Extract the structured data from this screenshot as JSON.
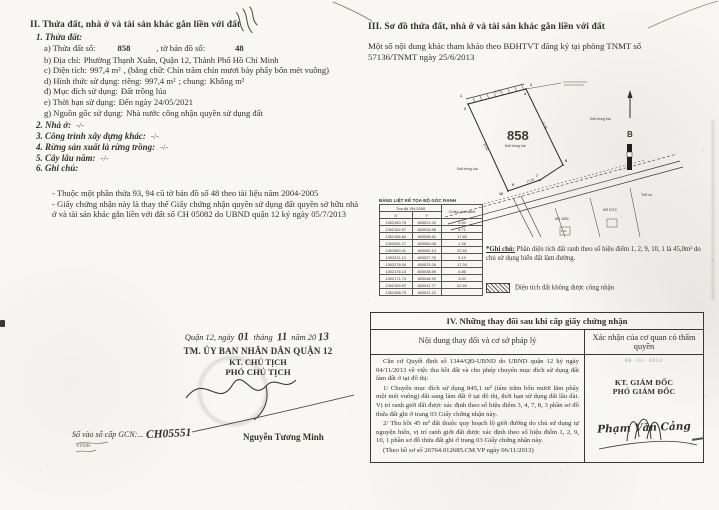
{
  "section2": {
    "title": "II. Thửa đất, nhà ở và tài sản khác gắn liền với đất",
    "plot_heading": "1. Thửa đất:",
    "plot_line": {
      "label1": "a) Thửa đất số:",
      "value1": "858",
      "label2": ", tờ bản đồ số:",
      "value2": "48"
    },
    "fields": [
      {
        "label": "b) Địa chỉ:",
        "value": "Phường Thạnh Xuân, Quận 12, Thành Phố Hồ Chí Minh",
        "label2": "",
        "value2": ""
      },
      {
        "label": "c) Diện tích:",
        "value": "997,4 m²",
        "label2": ", (bằng chữ: Chín trăm chín mươi bảy phẩy bốn mét vuông)",
        "value2": ""
      },
      {
        "label": "d) Hình thức sử dụng: riêng:",
        "value": "997,4 m²",
        "label2": "; chung:",
        "value2": "Không m²"
      },
      {
        "label": "đ) Mục đích sử dụng:",
        "value": "Đất trồng lúa",
        "label2": "",
        "value2": ""
      },
      {
        "label": "e) Thời hạn sử dụng:",
        "value": "Đến ngày 24/05/2021",
        "label2": "",
        "value2": ""
      },
      {
        "label": "g) Nguồn gốc sử dụng:",
        "value": "Nhà nước công nhận quyền sử dụng đất",
        "label2": "",
        "value2": ""
      }
    ],
    "subsections": [
      {
        "label": "2. Nhà ở:",
        "value": "-/-"
      },
      {
        "label": "3. Công trình xây dựng khác:",
        "value": "-/-"
      },
      {
        "label": "4. Rừng sản xuất là rừng trồng:",
        "value": "-/-"
      },
      {
        "label": "5. Cây lâu năm:",
        "value": "-/-"
      },
      {
        "label": "6. Ghi chú:",
        "value": ""
      }
    ],
    "notes": [
      {
        "text": "- Thuộc một phần thửa 93, 94 cũ tờ bản đồ số 48 theo tài liệu năm 2004-2005"
      },
      {
        "text": "- Giấy chứng nhận này là thay thế Giấy chứng nhận quyền sử dụng đất quyền sở hữu nhà ở và tài sản khác gắn liền với đất số CH 05082 do UBND quận 12 ký ngày 05/7/2013"
      }
    ]
  },
  "issuer": {
    "place_label": "Quận 12, ngày",
    "day": "01",
    "month_label": "tháng",
    "month": "11",
    "year_label": "năm 20",
    "year": "13",
    "committee": "TM. ỦY BAN NHÂN DÂN QUẬN 12",
    "kt": "KT. CHỦ TỊCH",
    "role": "PHÓ CHỦ TỊCH",
    "name": "Nguyễn Tương Minh",
    "book_label": "Số vào sổ cấp GCN:...",
    "book_no": "CH05551",
    "clerk_note": "VPĐK"
  },
  "section3": {
    "title": "III. Sơ đồ thửa đất, nhà ở và tài sản khác gắn liền với đất",
    "intro": "Một số nội dung khác tham khảo theo BĐHTVT đăng ký tại phòng TNMT số 57136/TNMT ngày 25/6/2013",
    "diagram": {
      "parcel_no": "858",
      "parcel_use": "Đất trồng lúa",
      "neighbor_use_left": "Đất trồng lúa",
      "neighbor_use_right": "Đất trồng lúa",
      "north_label": "B",
      "label_tho_cu": "Thổ cư",
      "label_ms1": "MS 1853",
      "label_ms2": "MS 6713",
      "label_house": "1 hộ",
      "edge_labels": [
        "6.71",
        "22.50",
        "17.34",
        "17.60"
      ],
      "point_labels": [
        "1",
        "2",
        "3",
        "4",
        "7",
        "8",
        "9",
        "10"
      ]
    },
    "coords_table": {
      "title": "BẢNG LIỆT KÊ TỌA ĐỘ GÓC RANH",
      "group_header": "Tọa độ VN-2000",
      "col_x": "X",
      "col_y": "Y",
      "col_len": "Chiều dài cạnh",
      "rows": [
        {
          "x": "1302160.75",
          "y": "600021.33",
          "len": "2.00"
        },
        {
          "x": "1302162.57",
          "y": "600028.58",
          "len": "6.71"
        },
        {
          "x": "1302166.84",
          "y": "600058.62",
          "len": "17.60"
        },
        {
          "x": "1302081.17",
          "y": "600063.08",
          "len": "1.26"
        },
        {
          "x": "1302083.41",
          "y": "600062.13",
          "len": "22.50"
        },
        {
          "x": "1302211.12",
          "y": "600027.76",
          "len": "5.19"
        },
        {
          "x": "1302278.04",
          "y": "600023.26",
          "len": "17.34"
        },
        {
          "x": "1302176.13",
          "y": "600038.59",
          "len": "5.86"
        },
        {
          "x": "1302171.74",
          "y": "600048.93",
          "len": "3.00"
        },
        {
          "x": "1302169.92",
          "y": "600041.77",
          "len": "22.50"
        },
        {
          "x": "1302168.75",
          "y": "600021.23",
          "len": ""
        }
      ]
    },
    "note_label": "*Ghi chú:",
    "note_text": "Phần diện tích đất ranh theo số hiệu điểm 1, 2, 9, 10, 1 là 45,0m² do chủ sử dụng hiến đất làm đường.",
    "legend_text": "Diện tích đất không được công nhận"
  },
  "section4": {
    "title": "IV. Những thay đổi sau khi cấp giấy chứng nhận",
    "col_left": "Nội dung thay đổi và cơ sở pháp lý",
    "col_right": "Xác nhận của cơ quan có thẩm quyền",
    "paragraphs": [
      {
        "text": "Căn cứ Quyết định số 1344/QĐ-UBND do UBND quận 12 ký ngày 04/11/2013 về việc thu hồi đất và cho phép chuyển mục đích sử dụng đất làm đất ở tại đô thị:"
      },
      {
        "text": "1/ Chuyển mục đích sử dụng 845,1 m² (tám trăm bốn mươi lăm phẩy một mét vuông) đất sang làm đất ở tại đô thị, thời hạn sử dụng đất lâu dài. Vị trí ranh giới đất được xác định theo số hiệu điểm 3, 4, 7, 8, 3 phần sơ đồ thửa đất ghi ở trang 03 Giấy chứng nhận này."
      },
      {
        "text": "2/ Thu hồi 45 m² đất thuộc quy hoạch lộ giới đường do chủ sử dụng tự nguyện hiến, vị trí ranh giới đất được xác định theo số hiệu điểm 1, 2, 9, 10, 1 phần sơ đồ thửa đất ghi ở trang 03 Giấy chứng nhận này."
      },
      {
        "text": "(Theo hồ sơ số 26764.012685.CM.VP ngày 06/11/2013)"
      }
    ],
    "stamp_date": "06 -11- 2013",
    "kt": "KT. GIÁM ĐỐC",
    "role": "PHÓ GIÁM ĐỐC",
    "name": "Phạm Văn Cảng"
  }
}
